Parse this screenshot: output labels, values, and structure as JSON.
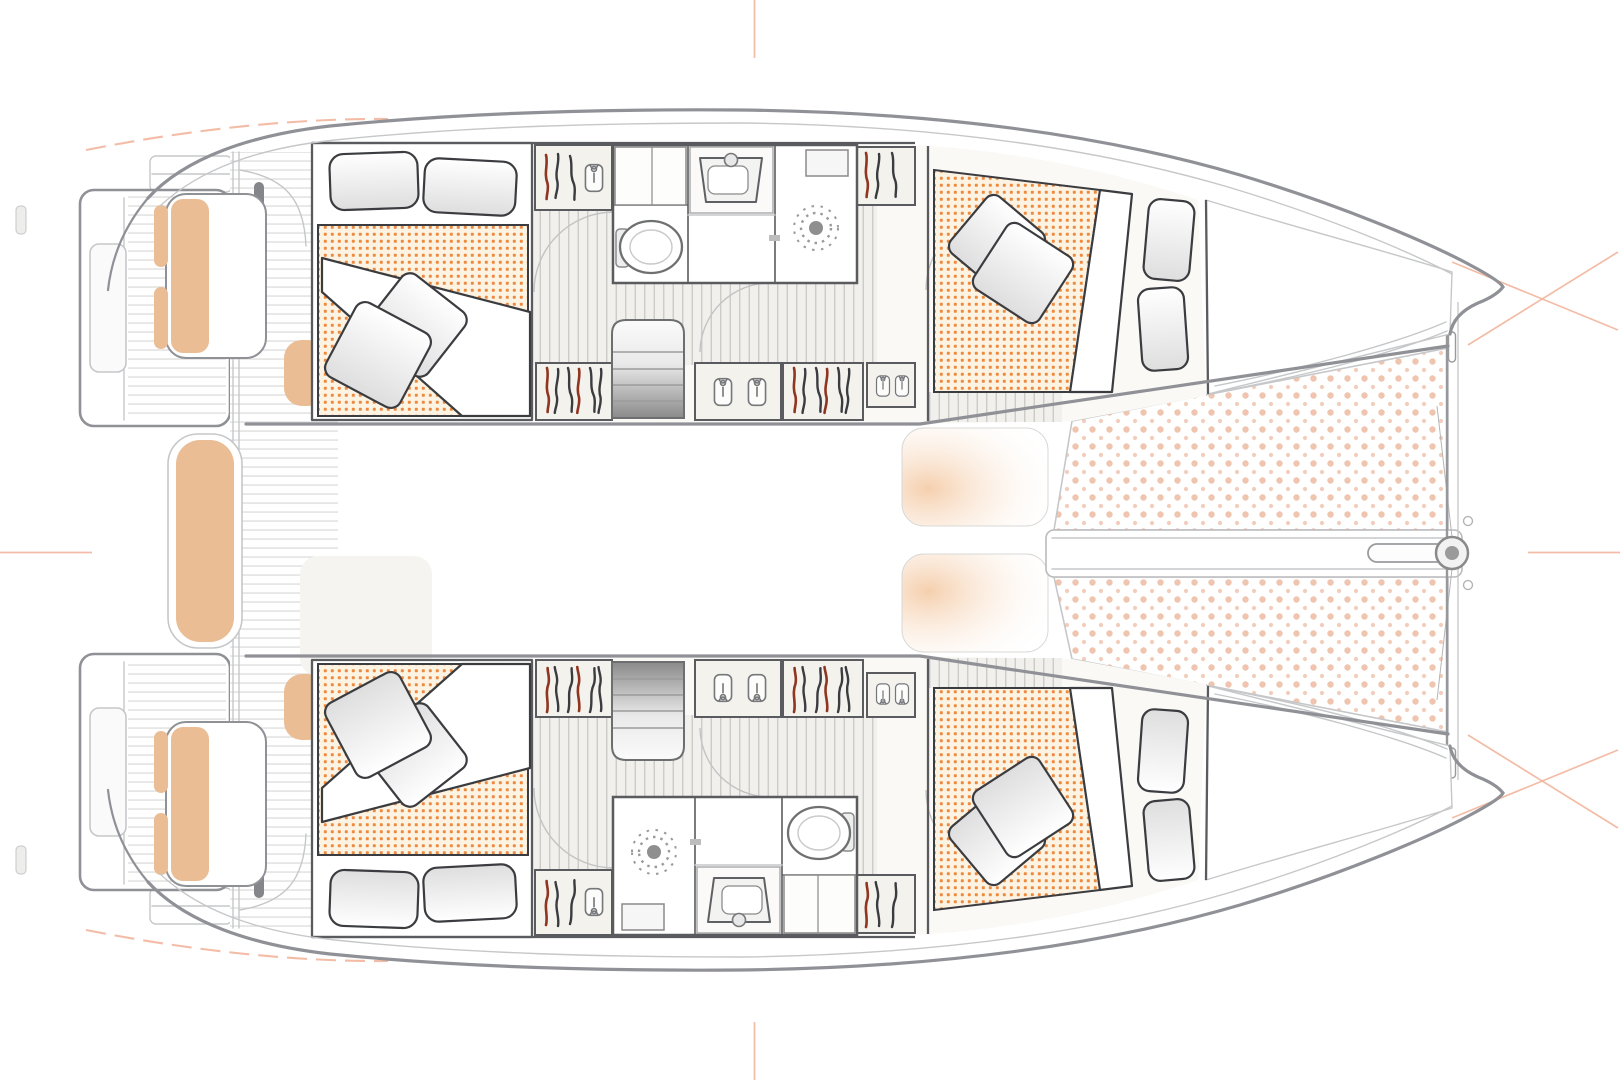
{
  "meta": {
    "title": "Sailing catamaran — overhead accommodation plan",
    "view": "deck plan, bow to the right"
  },
  "colors": {
    "hull_line": "#909196",
    "hull_line_soft": "#c6c7c9",
    "wall": "#5a5b5e",
    "furniture": "#3b3c40",
    "interior": "#faf9f6",
    "cabinet": "#f3f2ed",
    "floor": "#f1f0ec",
    "floor_line": "#c9c8c3",
    "deck_line": "#dddddc",
    "mattress_bg": "#fdf3e3",
    "mattress_dot": "#ec8a40",
    "tramp_dot": "#f0c5af",
    "cushion": "#eabd95",
    "peach": "#f5cfad",
    "accent_soft": "#f2b59c",
    "red_hanger": "#8f3520"
  },
  "plan": {
    "vessel": {
      "label": "Sailing catamaran — overhead accommodation plan",
      "bow": "right",
      "stern": "left"
    },
    "hulls": [
      {
        "label": "Port hull (top)",
        "cabins": [
          {
            "label": "Aft double cabin",
            "bed": {
              "pillows": 2,
              "throw_pillows": 2,
              "mattress_pattern": "orange-dot"
            }
          },
          {
            "label": "Forward double cabin",
            "bed": {
              "pillows": 2,
              "throw_pillows": 2,
              "mattress_pattern": "orange-dot"
            }
          }
        ],
        "bathroom": {
          "label": "Bathroom",
          "fixtures": [
            "toilet",
            "washbasin",
            "shower"
          ]
        },
        "wardrobes": 6,
        "companionway": {
          "label": "Companionway stairs"
        }
      },
      {
        "label": "Starboard hull (bottom)",
        "cabins": [
          {
            "label": "Aft double cabin",
            "bed": {
              "pillows": 2,
              "throw_pillows": 2,
              "mattress_pattern": "orange-dot"
            }
          },
          {
            "label": "Forward double cabin",
            "bed": {
              "pillows": 2,
              "throw_pillows": 2,
              "mattress_pattern": "orange-dot"
            }
          }
        ],
        "bathroom": {
          "label": "Bathroom",
          "fixtures": [
            "toilet",
            "washbasin",
            "shower"
          ]
        },
        "wardrobes": 6,
        "companionway": {
          "label": "Companionway stairs"
        }
      }
    ],
    "cockpit": {
      "label": "Aft cockpit and transom platforms",
      "benches": 3,
      "transom_platforms": 2,
      "helm_seat_pads": 2,
      "seat_cushions": 4
    },
    "foredeck": {
      "label": "Foredeck with trampolines",
      "trampolines": 2,
      "beam": "forward crossbeam",
      "bowsprit": true,
      "sunpads": 2
    },
    "guides": {
      "centerline_ticks": 4,
      "sheer_dash_arcs": 2,
      "bow_cross_marks": 2
    }
  }
}
